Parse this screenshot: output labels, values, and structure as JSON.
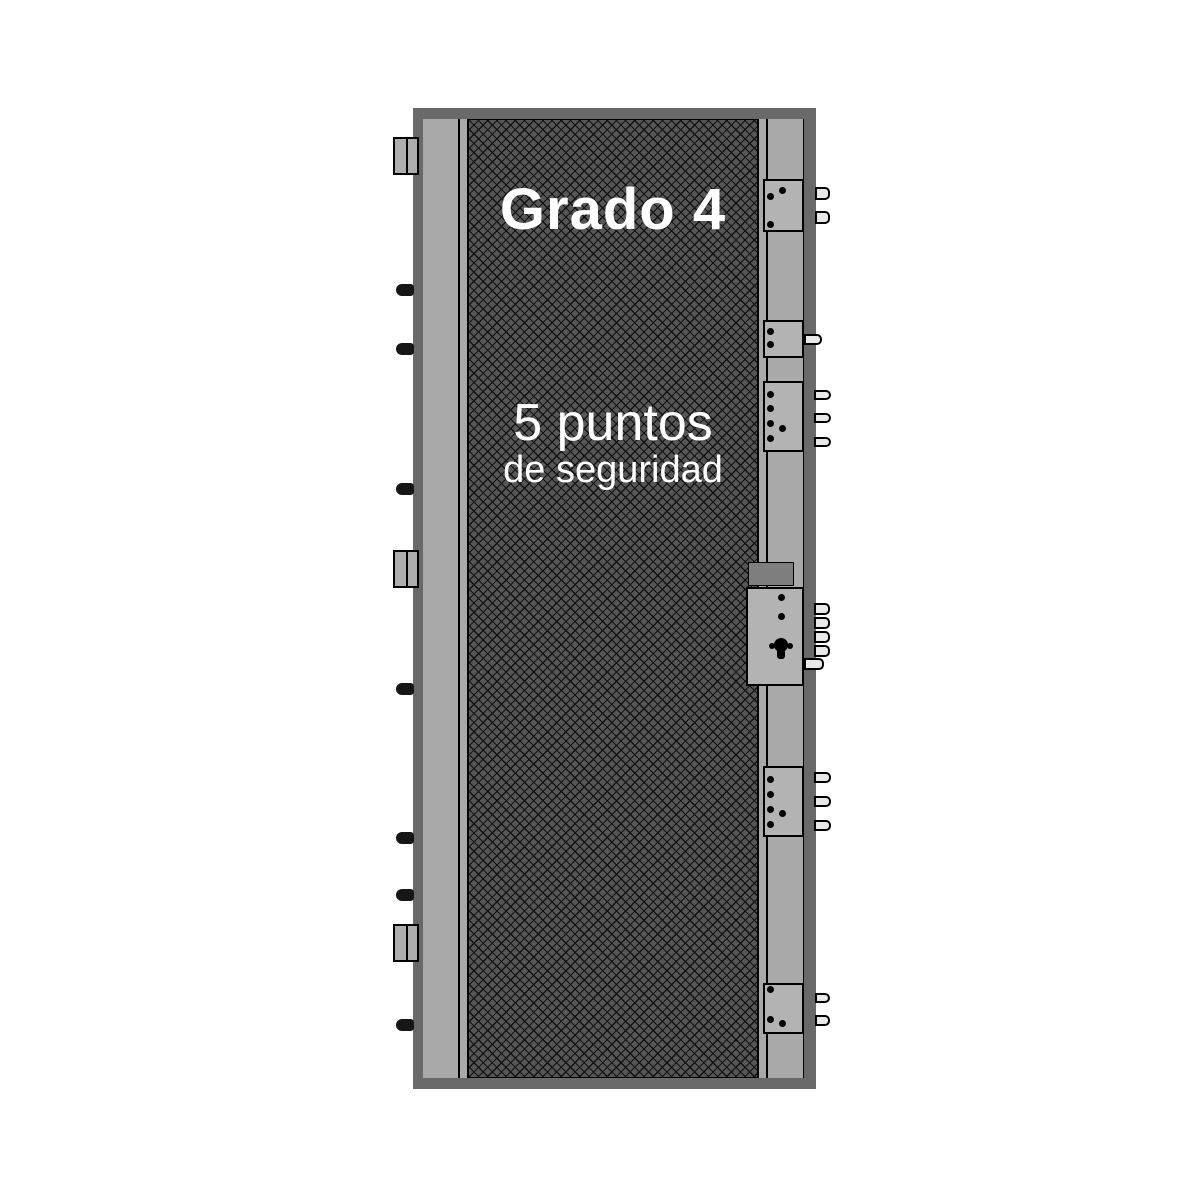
{
  "labels": {
    "grade": "Grado 4",
    "points_line1": "5 puntos",
    "points_line2": "de seguridad"
  },
  "colors": {
    "background": "#ffffff",
    "frame": "#696969",
    "panel": "#a9a9a9",
    "hatch-base": "#565656",
    "hatch-line": "#121212",
    "block": "#b3b3b3",
    "block-dark": "#7e7e7e",
    "bolt": "#e9e9e9",
    "pin": "#161616",
    "outline": "#000000",
    "text": "#ffffff"
  },
  "left_hardware": {
    "hinge_plates": [
      {
        "top": 137
      },
      {
        "top": 550
      },
      {
        "top": 924
      }
    ],
    "hinge_pins": [
      {
        "top": 284
      },
      {
        "top": 343
      },
      {
        "top": 483
      },
      {
        "top": 683
      },
      {
        "top": 832
      },
      {
        "top": 889
      },
      {
        "top": 1019
      }
    ]
  },
  "right_hardware": {
    "lock_points": [
      {
        "top": 179,
        "height": 53,
        "dots": [
          [
            770,
            196
          ],
          [
            782,
            190
          ],
          [
            770,
            224
          ]
        ],
        "bolts": [
          {
            "x": 815,
            "width": 15,
            "top": 187,
            "height": 13
          },
          {
            "x": 815,
            "width": 15,
            "top": 211,
            "height": 13
          }
        ]
      },
      {
        "top": 320,
        "height": 38,
        "dots": [
          [
            770,
            331
          ],
          [
            770,
            344
          ]
        ],
        "bolts": [
          {
            "x": 804,
            "width": 18,
            "top": 334,
            "height": 11
          }
        ]
      },
      {
        "top": 381,
        "height": 71,
        "dots": [
          [
            770,
            394
          ],
          [
            770,
            408
          ],
          [
            770,
            423
          ],
          [
            782,
            428
          ],
          [
            770,
            438
          ]
        ],
        "bolts": [
          {
            "x": 814,
            "width": 17,
            "top": 390,
            "height": 10
          },
          {
            "x": 814,
            "width": 17,
            "top": 413,
            "height": 10
          },
          {
            "x": 814,
            "width": 17,
            "top": 437,
            "height": 10
          }
        ]
      },
      {
        "top": 766,
        "height": 71,
        "dots": [
          [
            770,
            779
          ],
          [
            770,
            794
          ],
          [
            770,
            809
          ],
          [
            782,
            813
          ],
          [
            770,
            824
          ]
        ],
        "bolts": [
          {
            "x": 814,
            "width": 17,
            "top": 772,
            "height": 11
          },
          {
            "x": 814,
            "width": 17,
            "top": 796,
            "height": 11
          },
          {
            "x": 814,
            "width": 17,
            "top": 820,
            "height": 11
          }
        ]
      },
      {
        "top": 983,
        "height": 51,
        "dots": [
          [
            770,
            989
          ],
          [
            770,
            1019
          ],
          [
            782,
            1023
          ]
        ],
        "bolts": [
          {
            "x": 815,
            "width": 15,
            "top": 993,
            "height": 10
          },
          {
            "x": 815,
            "width": 15,
            "top": 1015,
            "height": 11
          }
        ]
      }
    ],
    "main_lock": {
      "follower_square": {
        "left": 748,
        "top": 562,
        "width": 46,
        "height": 24
      },
      "body": {
        "left": 746,
        "top": 587,
        "width": 58,
        "height": 99
      },
      "dots": [
        [
          781,
          597
        ],
        [
          781,
          616
        ]
      ],
      "keyhole": {
        "cx": 781,
        "cy": 645,
        "side_dots": [
          [
            772,
            646
          ],
          [
            790,
            646
          ]
        ]
      },
      "bolts": [
        {
          "x": 814,
          "width": 16,
          "top": 603,
          "height": 12
        },
        {
          "x": 814,
          "width": 16,
          "top": 617,
          "height": 12
        },
        {
          "x": 814,
          "width": 16,
          "top": 631,
          "height": 12
        },
        {
          "x": 814,
          "width": 16,
          "top": 645,
          "height": 12
        },
        {
          "x": 804,
          "width": 20,
          "top": 658,
          "height": 12
        }
      ]
    }
  }
}
